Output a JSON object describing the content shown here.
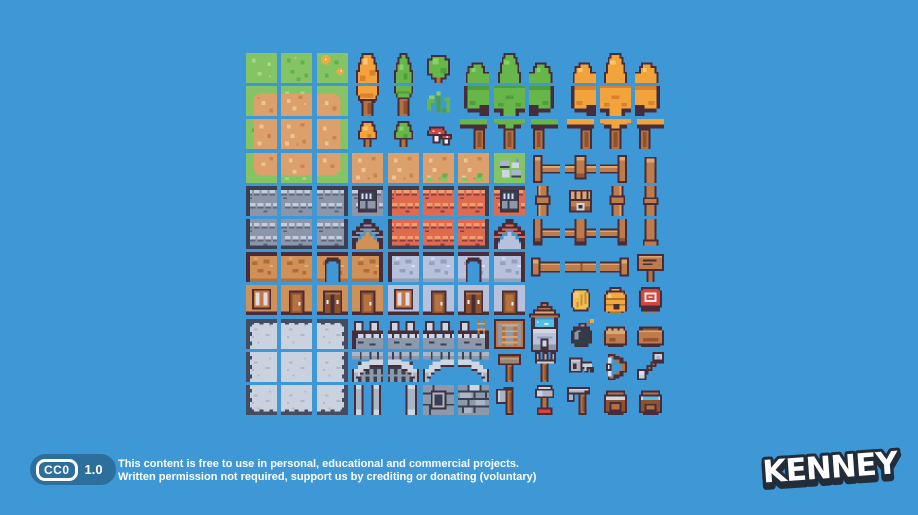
{
  "license": {
    "badge": {
      "cc_label": "CC0",
      "version": "1.0"
    },
    "line1": "This content is free to use in personal, educational and commercial projects.",
    "line2": "Written permission not required, support us by crediting or donating (voluntary)"
  },
  "logo": {
    "text": "KENNEY"
  },
  "palette": {
    "background": "#3E98D5",
    "badge_blue": "#2D6F9C",
    "text_white": "#FFFFFF",
    "logo_outline": "#232D3A",
    "outline": "#472D3C",
    "grass": "#85C465",
    "grass_dark": "#5FB14C",
    "grass_light": "#A7DB87",
    "dirt": "#DCA06C",
    "dirt_light": "#EDC496",
    "dirt_dark": "#C9854F",
    "tree_green": "#67B649",
    "tree_green_dark": "#4C9F39",
    "tree_green_light": "#8BCF69",
    "tree_orange": "#F2A33C",
    "tree_orange_dark": "#D9812C",
    "tree_orange_light": "#FFC971",
    "wood_trunk": "#B5713F",
    "wood_trunk_dark": "#8E532D",
    "roof_gray": "#8C96AB",
    "roof_gray_light": "#C3CBDC",
    "roof_gray_dark": "#5D6578",
    "roof_edge": "#3A4054",
    "roof_orange": "#E06A4E",
    "roof_orange_light": "#F29D69",
    "roof_orange_dark": "#8A3C4C",
    "wall_tan": "#D09056",
    "wall_tan_dark": "#AC6C3E",
    "wall_tan_shade": "#B0733F",
    "wall_tan_light": "#E3AD74",
    "wall_gray": "#B7C1DB",
    "wall_gray_dark": "#93A0BE",
    "stone": "#A9B6C6",
    "stone_light": "#CDD6E1",
    "stone_dark": "#39404F",
    "stone_mid": "#8D99AB",
    "floor": "#CBD2DF",
    "floor_border": "#454B61",
    "floor_speck": "#AEB8C9",
    "fence_wood": "#BE7C4B",
    "fence_wood_light": "#DCA76F",
    "fence_wood_dark": "#96542F",
    "wood_frame": "#C9763B",
    "white": "#F2EFE9",
    "pane": "#D9DEF2",
    "red": "#D8433B",
    "gold": "#F0BE52",
    "gold_dark": "#C98F33",
    "hive": "#F0A93F",
    "hive_dark": "#B27426",
    "water": "#4FC1E9",
    "metal": "#AAB4C2",
    "metal_light": "#C9D2DC",
    "bomb_black": "#343A46",
    "mallet": "#9B8573",
    "mallet_light": "#B3A08D"
  },
  "tileset": {
    "grid": {
      "columns": 12,
      "rows": 11,
      "origin_x": 246,
      "origin_y": 53,
      "pitch_x": 35.4,
      "pitch_y": 33.2,
      "tile_w": 31,
      "tile_h": 30
    },
    "tiles": [
      [
        1,
        1,
        "grass"
      ],
      [
        1,
        2,
        "grass_specks"
      ],
      [
        1,
        3,
        "grass_flowers"
      ],
      [
        1,
        4,
        "tree_top_orange"
      ],
      [
        1,
        5,
        "tree_top_green"
      ],
      [
        1,
        6,
        "bush_round"
      ],
      [
        1,
        7,
        "cluster_tl_green"
      ],
      [
        1,
        8,
        "cluster_t_green"
      ],
      [
        1,
        9,
        "cluster_tr_green"
      ],
      [
        1,
        10,
        "cluster_tl_orange"
      ],
      [
        1,
        11,
        "cluster_t_orange"
      ],
      [
        1,
        12,
        "cluster_tr_orange"
      ],
      [
        2,
        1,
        "dirt_tl"
      ],
      [
        2,
        2,
        "dirt_t"
      ],
      [
        2,
        3,
        "dirt_tr"
      ],
      [
        2,
        4,
        "tree_bottom_orange"
      ],
      [
        2,
        5,
        "tree_bottom_green"
      ],
      [
        2,
        6,
        "fern"
      ],
      [
        2,
        7,
        "cluster_ml_green"
      ],
      [
        2,
        8,
        "cluster_m_green"
      ],
      [
        2,
        9,
        "cluster_mr_green"
      ],
      [
        2,
        10,
        "cluster_ml_orange"
      ],
      [
        2,
        11,
        "cluster_m_orange"
      ],
      [
        2,
        12,
        "cluster_mr_orange"
      ],
      [
        3,
        1,
        "dirt_l"
      ],
      [
        3,
        2,
        "dirt_c"
      ],
      [
        3,
        3,
        "dirt_r"
      ],
      [
        3,
        4,
        "tree_small_orange"
      ],
      [
        3,
        5,
        "tree_small_green"
      ],
      [
        3,
        6,
        "mushrooms"
      ],
      [
        3,
        7,
        "cluster_bl_green"
      ],
      [
        3,
        8,
        "cluster_b_green"
      ],
      [
        3,
        9,
        "cluster_br_green"
      ],
      [
        3,
        10,
        "cluster_bl_orange"
      ],
      [
        3,
        11,
        "cluster_b_orange"
      ],
      [
        3,
        12,
        "cluster_br_orange"
      ],
      [
        4,
        1,
        "dirt_bl"
      ],
      [
        4,
        2,
        "dirt_b"
      ],
      [
        4,
        3,
        "dirt_br"
      ],
      [
        4,
        4,
        "dirt_c"
      ],
      [
        4,
        5,
        "dirt_c"
      ],
      [
        4,
        6,
        "dirt_tuft"
      ],
      [
        4,
        7,
        "dirt_tuft"
      ],
      [
        4,
        8,
        "stones_grass"
      ],
      [
        4,
        9,
        "fence_corner_tl"
      ],
      [
        4,
        10,
        "fence_top"
      ],
      [
        4,
        11,
        "fence_corner_tr"
      ],
      [
        4,
        12,
        "post_top"
      ],
      [
        5,
        1,
        "roof_gray_tl"
      ],
      [
        5,
        2,
        "roof_gray_t"
      ],
      [
        5,
        3,
        "roof_gray_tr"
      ],
      [
        5,
        4,
        "dormer_gray"
      ],
      [
        5,
        5,
        "roof_orange_tl"
      ],
      [
        5,
        6,
        "roof_orange_t"
      ],
      [
        5,
        7,
        "roof_orange_tr"
      ],
      [
        5,
        8,
        "dormer_orange"
      ],
      [
        5,
        9,
        "fence_side_l"
      ],
      [
        5,
        10,
        "chest"
      ],
      [
        5,
        11,
        "fence_side_r"
      ],
      [
        5,
        12,
        "post_mid"
      ],
      [
        6,
        1,
        "roof_gray_bl"
      ],
      [
        6,
        2,
        "roof_gray_b"
      ],
      [
        6,
        3,
        "roof_gray_br"
      ],
      [
        6,
        4,
        "gable_gray"
      ],
      [
        6,
        5,
        "roof_orange_bl"
      ],
      [
        6,
        6,
        "roof_orange_b"
      ],
      [
        6,
        7,
        "roof_orange_br"
      ],
      [
        6,
        8,
        "gable_orange"
      ],
      [
        6,
        9,
        "fence_corner_bl"
      ],
      [
        6,
        10,
        "fence_bottom"
      ],
      [
        6,
        11,
        "fence_corner_br"
      ],
      [
        6,
        12,
        "post_bottom"
      ],
      [
        7,
        1,
        "wall_tan_l"
      ],
      [
        7,
        2,
        "wall_tan_m"
      ],
      [
        7,
        3,
        "wall_tan_arch"
      ],
      [
        7,
        4,
        "wall_tan_r"
      ],
      [
        7,
        5,
        "wall_gray_l"
      ],
      [
        7,
        6,
        "wall_gray_m"
      ],
      [
        7,
        7,
        "wall_gray_arch"
      ],
      [
        7,
        8,
        "wall_gray_r"
      ],
      [
        7,
        9,
        "beam_l"
      ],
      [
        7,
        10,
        "beam_m"
      ],
      [
        7,
        11,
        "beam_r"
      ],
      [
        7,
        12,
        "sign"
      ],
      [
        8,
        1,
        "window_tan"
      ],
      [
        8,
        2,
        "door_tan_a"
      ],
      [
        8,
        3,
        "door_tan_b"
      ],
      [
        8,
        4,
        "door_tan_a"
      ],
      [
        8,
        5,
        "window_gray"
      ],
      [
        8,
        6,
        "door_gray_a"
      ],
      [
        8,
        7,
        "door_gray_b"
      ],
      [
        8,
        8,
        "door_gray_a"
      ],
      [
        8,
        9,
        "well",
        17,
        52
      ],
      [
        8,
        10,
        "coin"
      ],
      [
        8,
        11,
        "beehive"
      ],
      [
        8,
        12,
        "target"
      ],
      [
        9,
        1,
        "floor_tl"
      ],
      [
        9,
        2,
        "floor_t"
      ],
      [
        9,
        3,
        "floor_tr"
      ],
      [
        9,
        4,
        "battlement_l"
      ],
      [
        9,
        5,
        "battlement_m"
      ],
      [
        9,
        6,
        "battlement_m"
      ],
      [
        9,
        7,
        "battlement_r"
      ],
      [
        9,
        8,
        "ladder"
      ],
      [
        9,
        10,
        "bomb"
      ],
      [
        9,
        11,
        "sack"
      ],
      [
        9,
        12,
        "basket"
      ],
      [
        10,
        1,
        "floor_l"
      ],
      [
        10,
        2,
        "floor_c"
      ],
      [
        10,
        3,
        "floor_r"
      ],
      [
        10,
        4,
        "arch_closed_l"
      ],
      [
        10,
        5,
        "arch_closed_r"
      ],
      [
        10,
        6,
        "arch_open_l"
      ],
      [
        10,
        7,
        "arch_open_r"
      ],
      [
        10,
        8,
        "hammer"
      ],
      [
        10,
        9,
        "pitchfork"
      ],
      [
        10,
        10,
        "key"
      ],
      [
        10,
        11,
        "bow"
      ],
      [
        10,
        12,
        "arrow"
      ],
      [
        11,
        1,
        "floor_bl"
      ],
      [
        11,
        2,
        "floor_b"
      ],
      [
        11,
        3,
        "floor_br"
      ],
      [
        11,
        4,
        "pillar_pair"
      ],
      [
        11,
        5,
        "pillar_single"
      ],
      [
        11,
        6,
        "stone_wall_window"
      ],
      [
        11,
        7,
        "stone_wall_brick"
      ],
      [
        11,
        8,
        "axe"
      ],
      [
        11,
        9,
        "shovel"
      ],
      [
        11,
        10,
        "scythe"
      ],
      [
        11,
        11,
        "bag"
      ],
      [
        11,
        12,
        "bag_open"
      ]
    ]
  }
}
